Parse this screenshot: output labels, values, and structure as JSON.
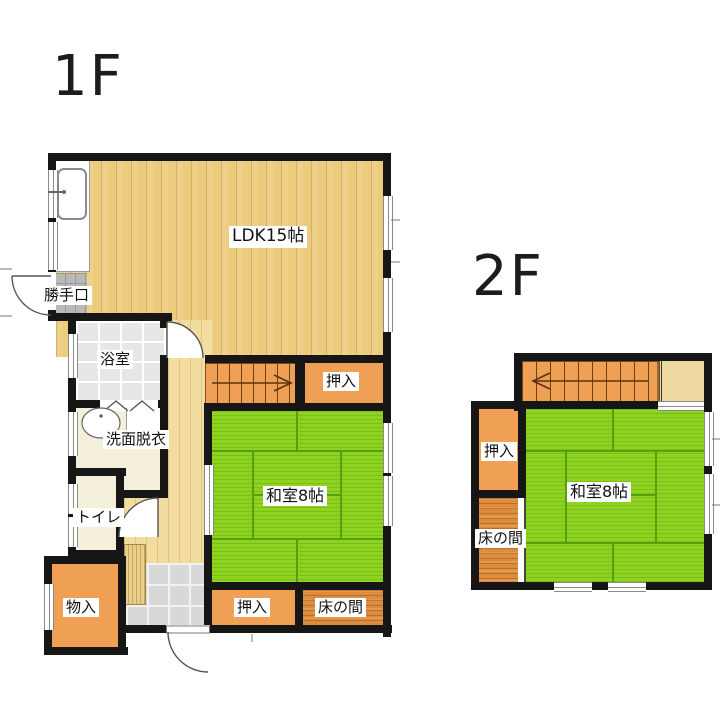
{
  "document": {
    "type": "house-floor-plan"
  },
  "floor1": {
    "label": "1F",
    "rooms": {
      "ldk": "LDK15帖",
      "katteguchi": "勝手口",
      "bathroom": "浴室",
      "washroom": "洗面脱衣",
      "toilet": "トイレ",
      "monoire": "物入",
      "oshiire_top": "押入",
      "washitsu": "和室8帖",
      "oshiire_bottom": "押入",
      "tokonoma": "床の間"
    },
    "stairs_arrow_direction": "right"
  },
  "floor2": {
    "label": "2F",
    "rooms": {
      "oshiire": "押入",
      "washitsu": "和室8帖",
      "tokonoma": "床の間"
    },
    "stairs_arrow_direction": "left"
  },
  "colors": {
    "wall": "#161616",
    "ldk_floor": "#edcb7c",
    "hall_floor": "#f2dc9f",
    "tatami_green": "#8ed31f",
    "closet_orange": "#efa055",
    "tokonoma_wood": "#dd8c3e",
    "bath_tile": "#e7e7e7",
    "genkan_tile": "#d8d8d8",
    "background": "#ffffff"
  }
}
